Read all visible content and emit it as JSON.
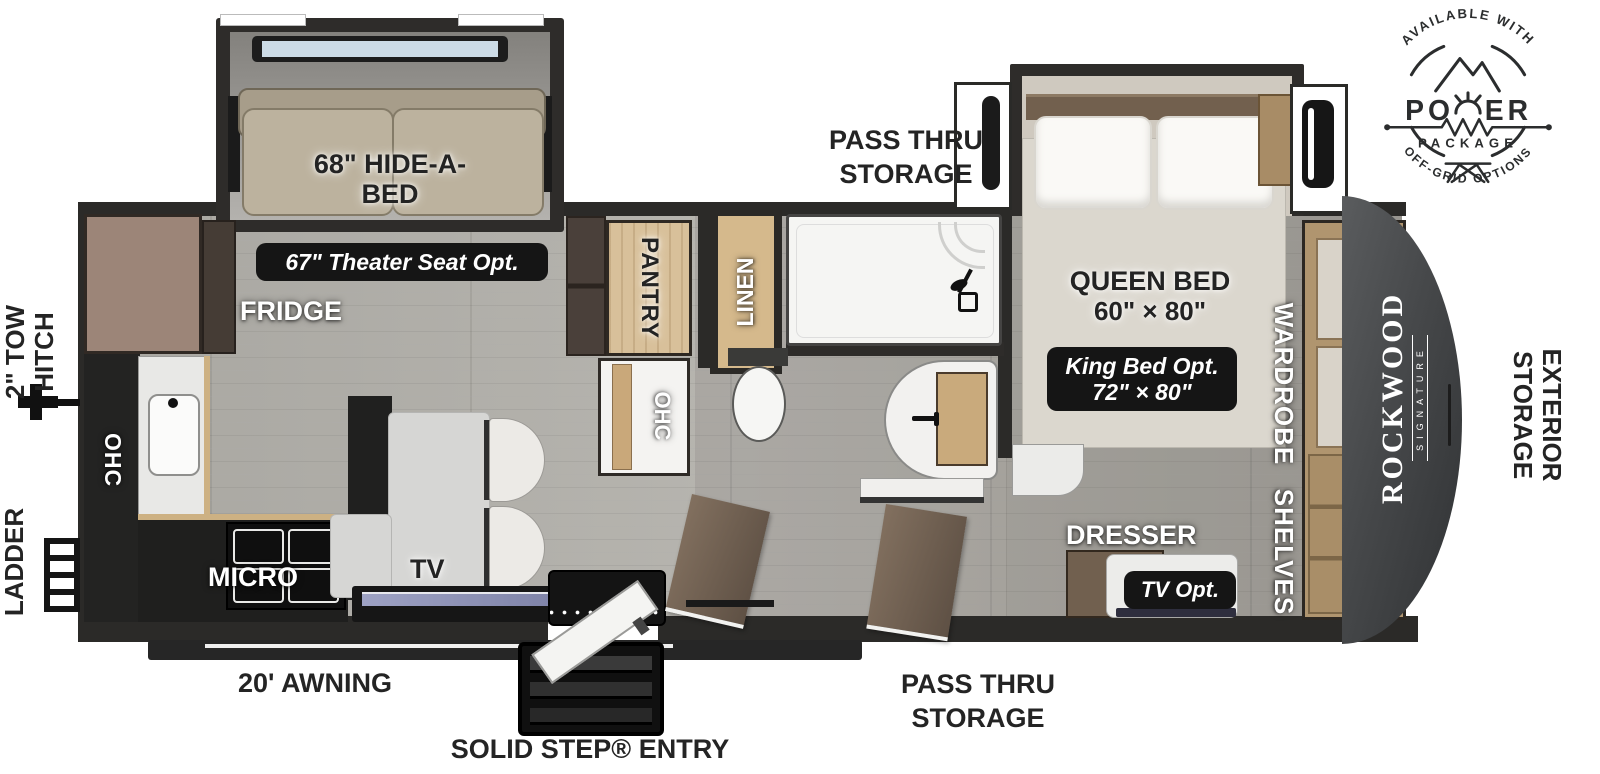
{
  "badge": {
    "arc_top": "AVAILABLE WITH",
    "power_left": "PO",
    "power_right": "ER",
    "package": "PACKAGE",
    "arc_bottom": "OFF-GRID OPTIONS"
  },
  "brand": {
    "name": "ROCKWOOD",
    "series": "SIGNATURE"
  },
  "exterior": {
    "tow_hitch_line1": "2\" TOW",
    "tow_hitch_line2": "HITCH",
    "ladder": "LADDER",
    "awning": "20' AWNING",
    "entry": "SOLID STEP® ENTRY",
    "pass_thru_top_line1": "PASS THRU",
    "pass_thru_top_line2": "STORAGE",
    "pass_thru_bottom_line1": "PASS THRU",
    "pass_thru_bottom_line2": "STORAGE",
    "exterior_storage_line1": "EXTERIOR",
    "exterior_storage_line2": "STORAGE"
  },
  "living": {
    "hide_a_bed_line1": "68\" HIDE-A-",
    "hide_a_bed_line2": "BED",
    "theater_opt": "67\" Theater Seat Opt.",
    "fridge": "FRIDGE",
    "ohc": "OHC",
    "micro": "MICRO",
    "tv": "TV"
  },
  "midship": {
    "pantry": "PANTRY",
    "ohc": "OHC",
    "linen": "LINEN"
  },
  "bedroom": {
    "queen_line1": "QUEEN BED",
    "queen_line2": "60\" × 80\"",
    "king_line1": "King Bed Opt.",
    "king_line2": "72\" × 80\"",
    "wardrobe": "WARDROBE",
    "shelves": "SHELVES",
    "dresser": "DRESSER",
    "tv_opt": "TV Opt."
  }
}
